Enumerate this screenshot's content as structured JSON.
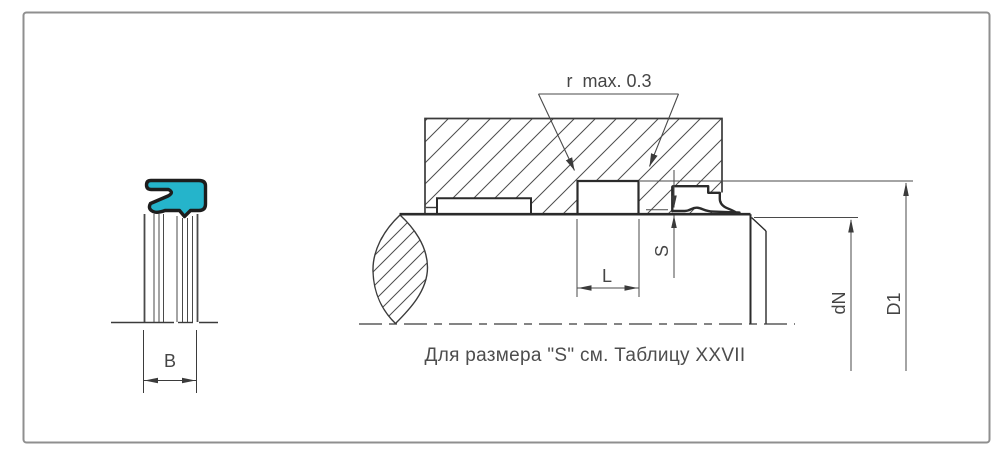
{
  "drawing": {
    "caption": "Для размера \"S\" см. Таблицу XXVII",
    "labels": {
      "corner_radius": "r  max. 0.3",
      "groove_length": "L",
      "clearance": "S",
      "rod_diameter": "dN",
      "groove_diameter": "D1",
      "seal_width": "B"
    },
    "colors": {
      "seal_accent": "#25b4cb",
      "line": "#3b3b3b",
      "frame_border": "#8f8f8f",
      "text": "#454545"
    }
  }
}
